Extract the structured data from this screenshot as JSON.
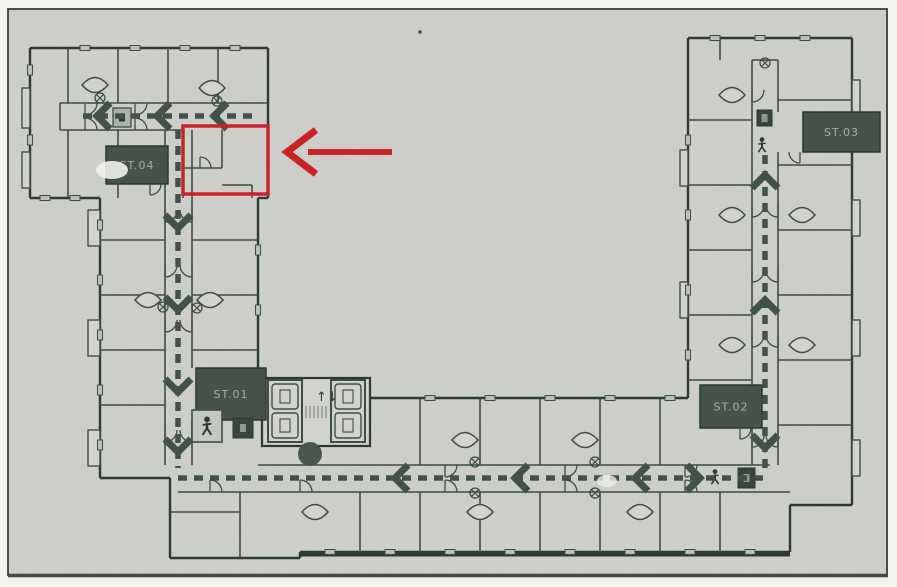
{
  "document": {
    "kind_label": "scanned floor plan page"
  },
  "page": {
    "bg": "#f3f2ee",
    "paper": "#d2d3cf",
    "frame_color": "#3d3d3a"
  },
  "plan": {
    "ink": "#3f4c44",
    "ink_dark": "#2c3832",
    "ink_light": "#707f75",
    "route_color": "#42514a",
    "block_fill": "#465349",
    "block_text_color": "#a3b1a6",
    "window_fill": "#b9c1b8",
    "circle_fill": "#4a564c"
  },
  "stairs": [
    {
      "id": "stair-st04",
      "label": "ST.04",
      "x": 106,
      "y": 146,
      "w": 62,
      "h": 38
    },
    {
      "id": "stair-st01",
      "label": "ST.01",
      "x": 196,
      "y": 368,
      "w": 70,
      "h": 52
    },
    {
      "id": "stair-st02",
      "label": "ST.02",
      "x": 700,
      "y": 385,
      "w": 62,
      "h": 43
    },
    {
      "id": "stair-st03",
      "label": "ST.03",
      "x": 803,
      "y": 112,
      "w": 77,
      "h": 40
    }
  ],
  "elevator_lobby": {
    "arrows_glyph": "↑↓",
    "shaft_count": 4
  },
  "icons": [
    {
      "name": "fire-equipment-icon",
      "x": 113,
      "y": 108,
      "w": 18,
      "h": 19,
      "style": "light"
    },
    {
      "name": "person-icon",
      "x": 192,
      "y": 410,
      "w": 30,
      "h": 32,
      "framed": true
    },
    {
      "name": "fire-equipment-icon",
      "x": 233,
      "y": 418,
      "w": 20,
      "h": 20,
      "style": "dark"
    },
    {
      "name": "fire-equipment-icon",
      "x": 757,
      "y": 110,
      "w": 15,
      "h": 16,
      "style": "dark"
    },
    {
      "name": "person-icon",
      "x": 753,
      "y": 134,
      "w": 18,
      "h": 22,
      "framed": false
    },
    {
      "name": "person-icon",
      "x": 706,
      "y": 466,
      "w": 18,
      "h": 22,
      "framed": false
    },
    {
      "name": "fire-equipment-icon",
      "x": 738,
      "y": 468,
      "w": 17,
      "h": 20,
      "style": "dark"
    }
  ],
  "escape_routes": [
    {
      "name": "top-left-corridor",
      "points": [
        [
          252,
          116
        ],
        [
          80,
          116
        ]
      ],
      "chevrons": [
        {
          "x": 97,
          "y": 116,
          "dir": "left"
        },
        {
          "x": 157,
          "y": 116,
          "dir": "left"
        },
        {
          "x": 214,
          "y": 116,
          "dir": "left"
        }
      ]
    },
    {
      "name": "left-wing-corridor",
      "points": [
        [
          178,
          130
        ],
        [
          178,
          468
        ]
      ],
      "chevrons": [
        {
          "x": 178,
          "y": 228,
          "dir": "down"
        },
        {
          "x": 178,
          "y": 310,
          "dir": "down"
        },
        {
          "x": 178,
          "y": 392,
          "dir": "down"
        },
        {
          "x": 178,
          "y": 452,
          "dir": "down"
        }
      ]
    },
    {
      "name": "bottom-corridor",
      "points": [
        [
          178,
          478
        ],
        [
          768,
          478
        ]
      ],
      "chevrons": [
        {
          "x": 395,
          "y": 478,
          "dir": "left"
        },
        {
          "x": 515,
          "y": 478,
          "dir": "left"
        },
        {
          "x": 635,
          "y": 478,
          "dir": "left"
        },
        {
          "x": 700,
          "y": 478,
          "dir": "right"
        }
      ]
    },
    {
      "name": "right-wing-corridor",
      "points": [
        [
          765,
          155
        ],
        [
          765,
          470
        ]
      ],
      "chevrons": [
        {
          "x": 765,
          "y": 175,
          "dir": "up"
        },
        {
          "x": 765,
          "y": 300,
          "dir": "up"
        },
        {
          "x": 765,
          "y": 448,
          "dir": "down"
        }
      ]
    }
  ],
  "annotation": {
    "color": "#c8232a",
    "highlight_box": {
      "x": 183,
      "y": 126,
      "w": 85,
      "h": 68,
      "stroke_width": 3.5
    },
    "arrow": {
      "tip": [
        287,
        152
      ],
      "tail": [
        392,
        152
      ],
      "head_back_x": 316,
      "head_half_height": 22,
      "shaft_width": 6,
      "head_width": 7
    }
  }
}
